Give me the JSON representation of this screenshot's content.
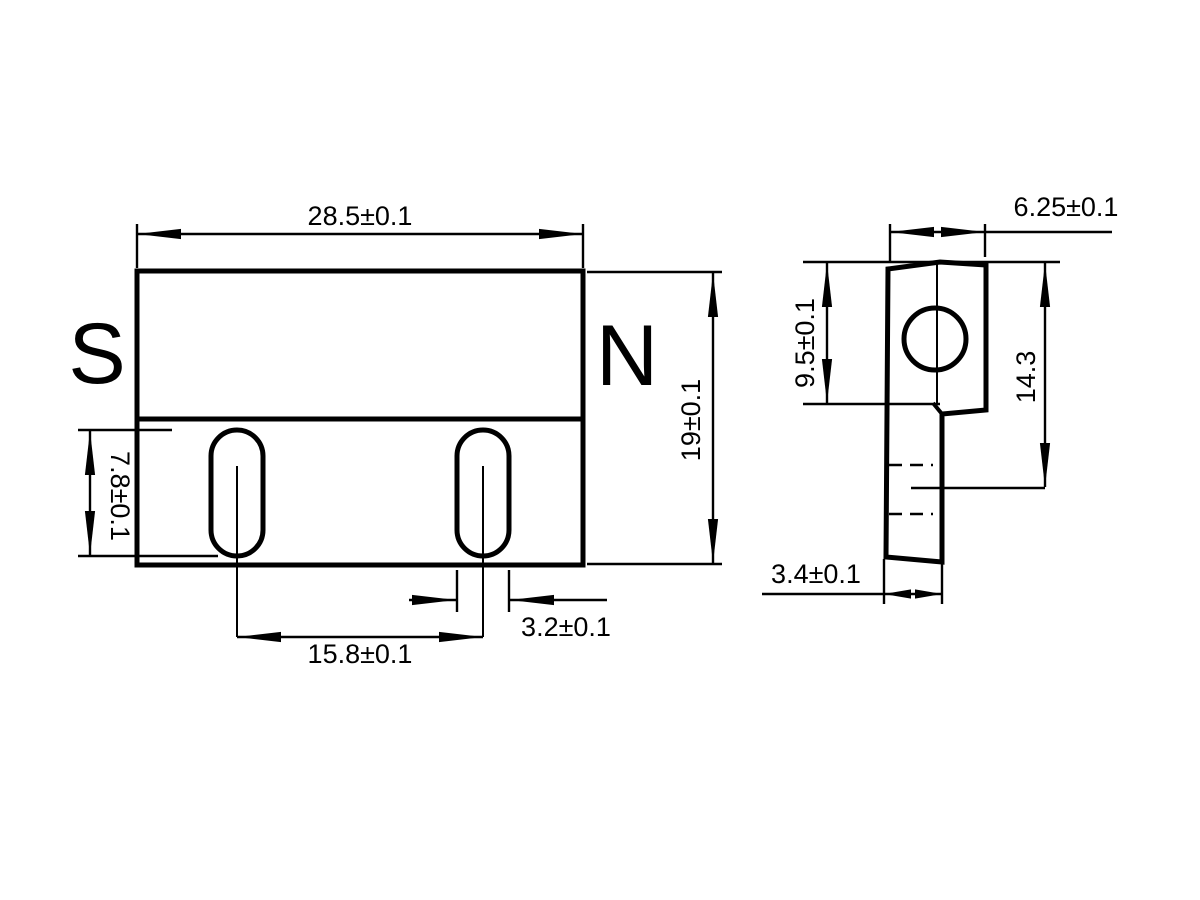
{
  "front_view": {
    "pole_south": "S",
    "pole_north": "N",
    "dims": {
      "overall_width": "28.5±0.1",
      "overall_height": "19±0.1",
      "slot_height": "7.8±0.1",
      "slot_spacing": "15.8±0.1",
      "slot_width": "3.2±0.1"
    }
  },
  "side_view": {
    "dims": {
      "depth": "6.25±0.1",
      "upper_height": "9.5±0.1",
      "hole_center_depth": "14.3",
      "base_thickness": "3.4±0.1"
    }
  },
  "colors": {
    "line": "#000000",
    "background": "#ffffff"
  }
}
